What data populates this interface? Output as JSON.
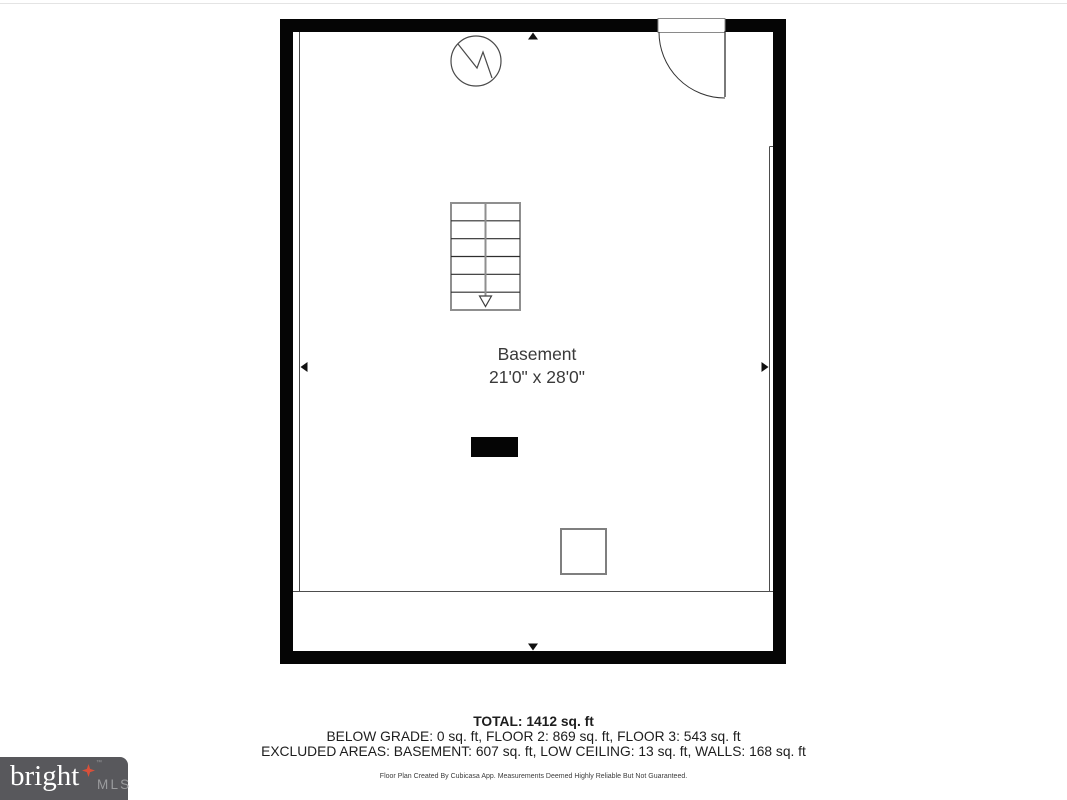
{
  "plan": {
    "room": {
      "name": "Basement",
      "dimensions": "21'0\" x 28'0\""
    },
    "features": {
      "staircase": "staircase-down",
      "door": "entry-door-swing",
      "utility_symbol": "water-heater-icon",
      "column": "support-column",
      "fixture": "utility-box"
    },
    "dimension_markers": [
      "arrow-up-icon",
      "arrow-down-icon",
      "arrow-left-icon",
      "arrow-right-icon"
    ]
  },
  "summary": {
    "total": "TOTAL: 1412 sq. ft",
    "floors": "BELOW GRADE: 0 sq. ft, FLOOR 2: 869 sq. ft, FLOOR 3: 543 sq. ft",
    "excluded": "EXCLUDED AREAS: BASEMENT: 607 sq. ft, LOW CEILING: 13 sq. ft, WALLS: 168 sq. ft",
    "disclaimer": "Floor Plan Created By Cubicasa App. Measurements Deemed Highly Reliable But Not Guaranteed."
  },
  "branding": {
    "name": "bright",
    "suffix": "MLS",
    "trademark": "™",
    "background": "#58585c",
    "star_color": "#d9503a",
    "suffix_color": "#9b9c9e",
    "trademark_color": "#97989b"
  },
  "colors": {
    "wall": "#050505",
    "interior_line": "#4d4d4d",
    "label_text": "#3a3a3a",
    "summary_text": "#1d1d1d"
  }
}
